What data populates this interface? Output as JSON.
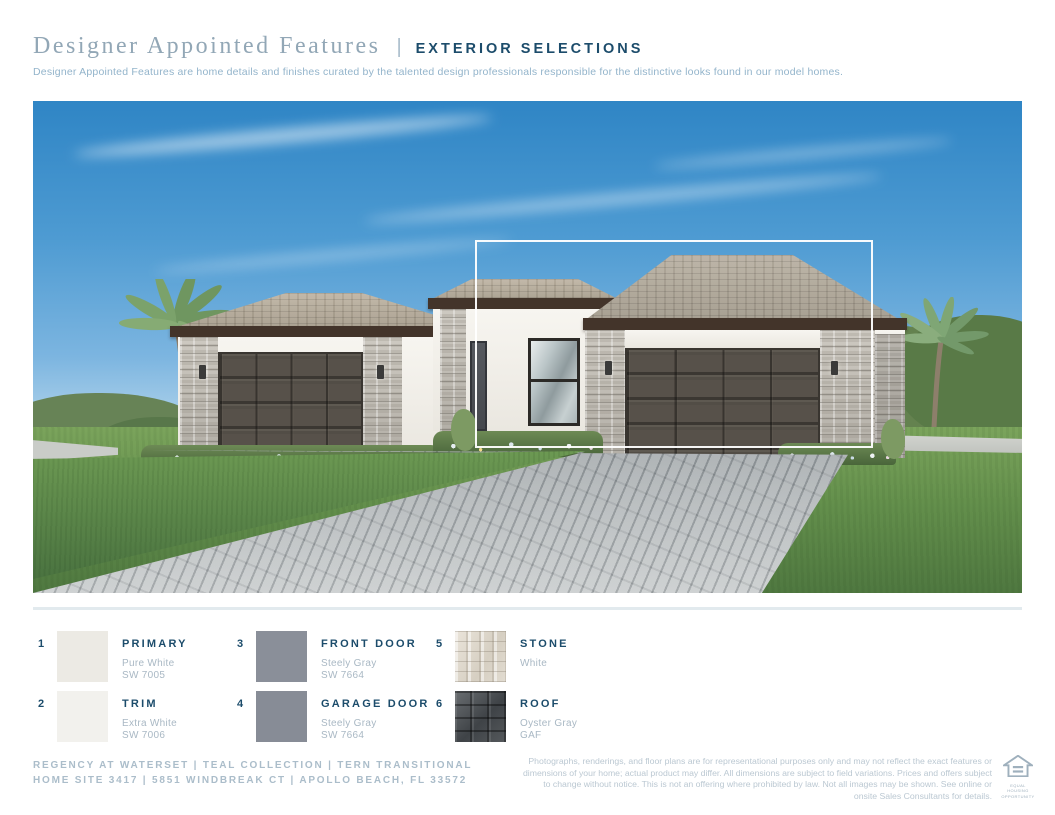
{
  "header": {
    "title": "Designer Appointed Features",
    "pipe": "|",
    "section": "EXTERIOR SELECTIONS",
    "description": "Designer Appointed Features are home details and finishes curated by the talented design professionals responsible for the distinctive looks found in our model homes."
  },
  "selections": [
    {
      "number": "1",
      "label": "PRIMARY",
      "color_name": "Pure White",
      "color_code": "SW 7005",
      "swatch": "solid",
      "color": "#ECEAE4"
    },
    {
      "number": "2",
      "label": "TRIM",
      "color_name": "Extra White",
      "color_code": "SW 7006",
      "swatch": "solid",
      "color": "#F2F1ED"
    },
    {
      "number": "3",
      "label": "FRONT DOOR",
      "color_name": "Steely Gray",
      "color_code": "SW 7664",
      "swatch": "solid",
      "color": "#8A8F99"
    },
    {
      "number": "4",
      "label": "GARAGE DOOR",
      "color_name": "Steely Gray",
      "color_code": "SW 7664",
      "swatch": "solid",
      "color": "#878C96"
    },
    {
      "number": "5",
      "label": "STONE",
      "color_name": "White",
      "color_code": "",
      "swatch": "stone"
    },
    {
      "number": "6",
      "label": "ROOF",
      "color_name": "Oyster Gray",
      "color_code": "GAF",
      "swatch": "roof"
    }
  ],
  "footer": {
    "community": "REGENCY AT WATERSET  |  TEAL COLLECTION  |  TERN TRANSITIONAL",
    "address": "HOME SITE 3417  |  5851 WINDBREAK CT  |  APOLLO BEACH, FL 33572",
    "disclaimer": "Photographs, renderings, and floor plans are for representational purposes only and may not reflect the exact features or dimensions of your home; actual product may differ. All dimensions are subject to field variations. Prices and offers subject to change without notice. This is not an offering where prohibited by law. Not all images may be shown. See online or onsite Sales Consultants for details.",
    "equal_housing_line1": "EQUAL HOUSING",
    "equal_housing_line2": "OPPORTUNITY"
  },
  "colors": {
    "navy": "#1C4C6B",
    "title_gray_blue": "#92A7B6",
    "light_blue_text": "#93B4CB",
    "muted_text": "#A9B8C4",
    "footer_text": "#ABBDCA",
    "disclaimer_text": "#BBC8D2"
  }
}
